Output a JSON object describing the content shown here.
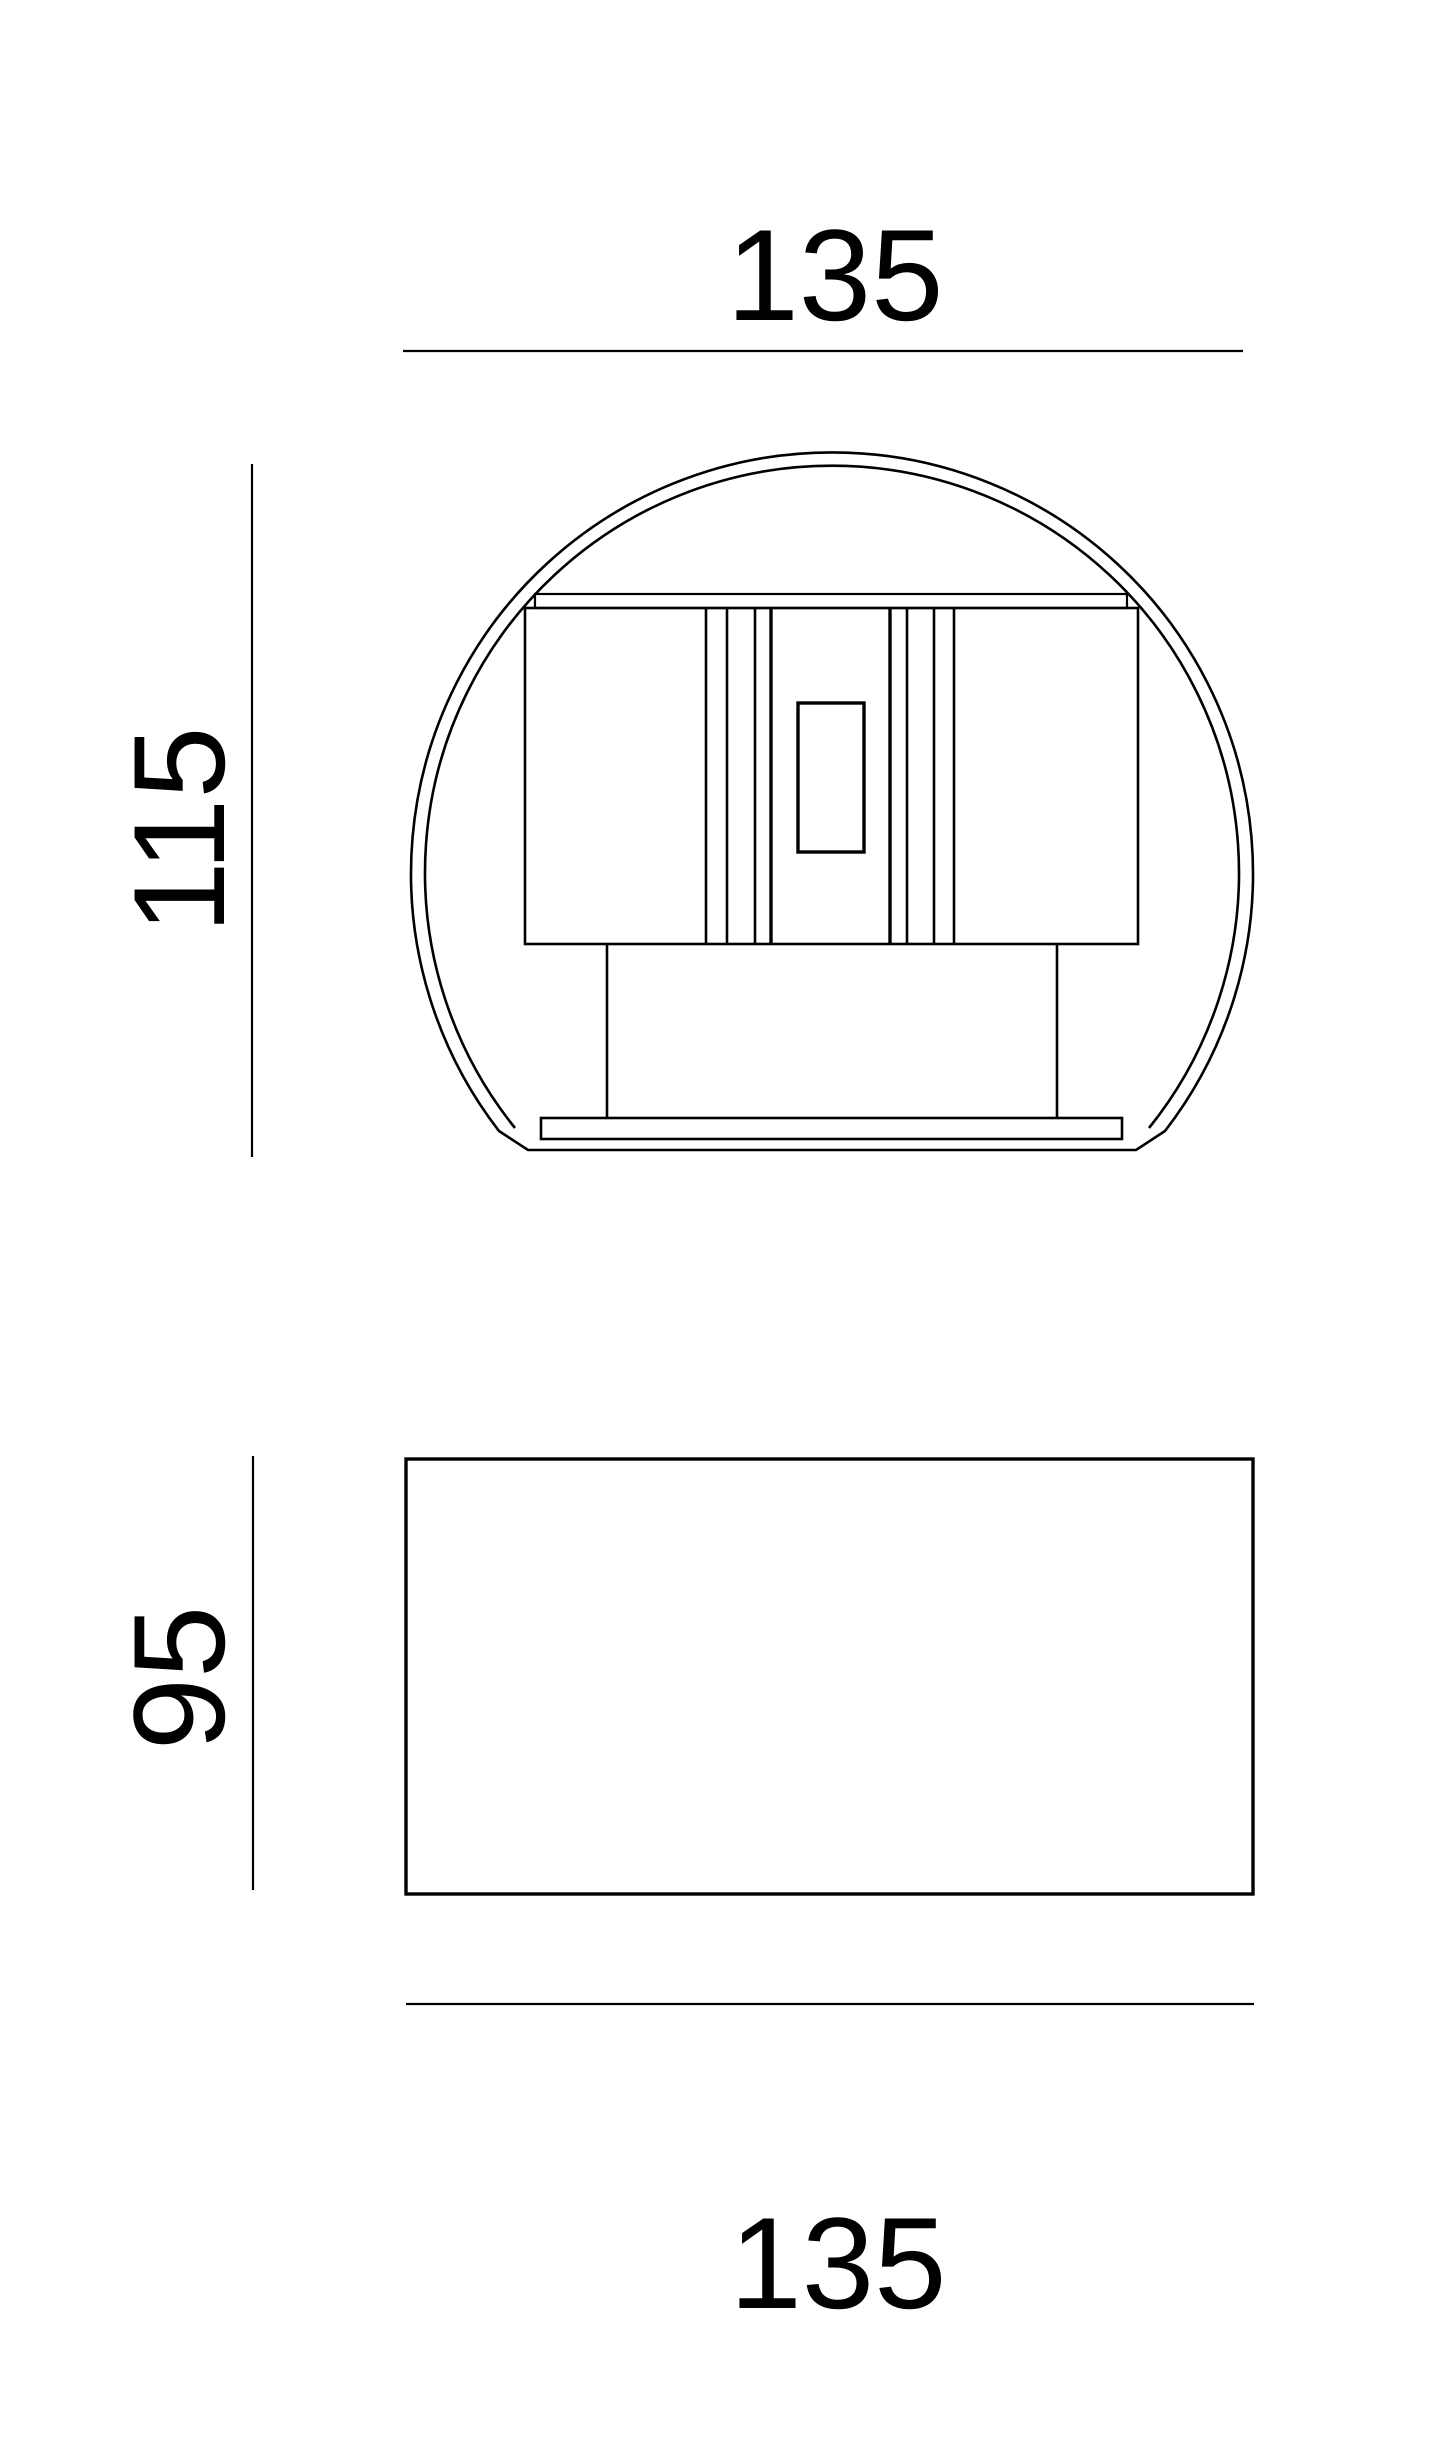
{
  "style": {
    "background": "#ffffff",
    "line_color": "#000000",
    "text_color": "#000000"
  },
  "drawing": {
    "kind": "technical dimension drawing, round wall luminaire",
    "top_view": {
      "width_label": "135",
      "height_label": "115"
    },
    "front_view": {
      "height_label": "95",
      "width_label": "135"
    }
  }
}
